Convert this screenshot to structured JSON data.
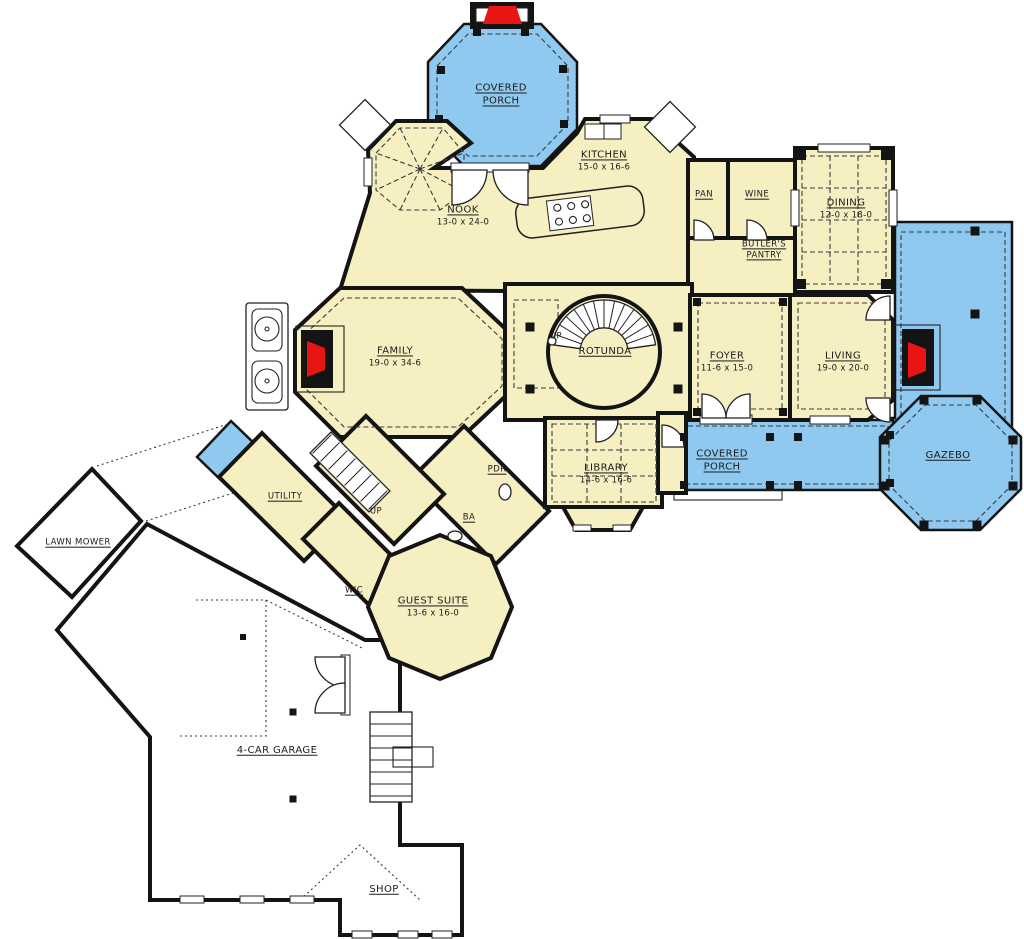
{
  "palette": {
    "room_fill": "#F5EFC2",
    "porch_fill": "#8FC9F0",
    "fireplace_red": "#E91414",
    "wall": "#141414",
    "paper": "#FFFFFF"
  },
  "labels": [
    {
      "id": "covered-porch-top",
      "line1": "COVERED",
      "line2": "PORCH"
    },
    {
      "id": "kitchen",
      "line1": "KITCHEN",
      "dims": "15-0 x 16-6"
    },
    {
      "id": "nook",
      "line1": "NOOK",
      "dims": "13-0 x 24-0"
    },
    {
      "id": "pan",
      "line1": "PAN"
    },
    {
      "id": "wine",
      "line1": "WINE"
    },
    {
      "id": "dining",
      "line1": "DINING",
      "dims": "12-0 x 18-0"
    },
    {
      "id": "butlers-pantry",
      "line1": "BUTLER'S",
      "line2": "PANTRY"
    },
    {
      "id": "family",
      "line1": "FAMILY",
      "dims": "19-0 x 34-6"
    },
    {
      "id": "rotunda",
      "line1": "ROTUNDA"
    },
    {
      "id": "foyer",
      "line1": "FOYER",
      "dims": "11-6 x 15-0"
    },
    {
      "id": "living",
      "line1": "LIVING",
      "dims": "19-0 x 20-0"
    },
    {
      "id": "gazebo",
      "line1": "GAZEBO"
    },
    {
      "id": "covered-porch-bottom",
      "line1": "COVERED",
      "line2": "PORCH"
    },
    {
      "id": "library",
      "line1": "LIBRARY",
      "dims": "14-6 x 16-6"
    },
    {
      "id": "pdr",
      "line1": "PDR"
    },
    {
      "id": "ba",
      "line1": "BA"
    },
    {
      "id": "utility",
      "line1": "UTILITY"
    },
    {
      "id": "wic",
      "line1": "WIC"
    },
    {
      "id": "guest-suite",
      "line1": "GUEST SUITE",
      "dims": "13-6 x 16-0"
    },
    {
      "id": "lawn-mower",
      "line1": "LAWN MOWER"
    },
    {
      "id": "garage",
      "line1": "4-CAR GARAGE"
    },
    {
      "id": "shop",
      "line1": "SHOP"
    },
    {
      "id": "up-rotunda",
      "line1": "UP"
    },
    {
      "id": "up-back-stairs",
      "line1": "UP"
    }
  ]
}
